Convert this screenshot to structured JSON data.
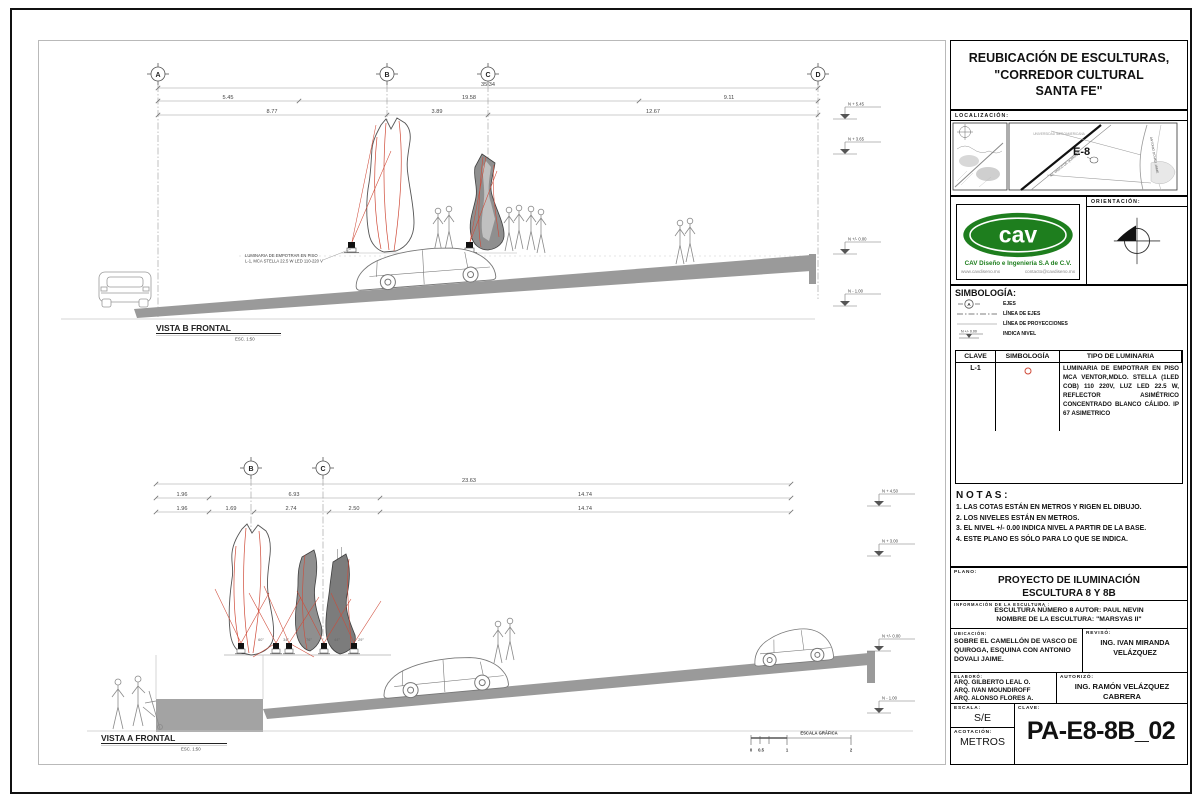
{
  "colors": {
    "accent_red": "#cf4a38",
    "logo_green": "#1e7e1e",
    "line_gray": "#8a8a8a"
  },
  "views": {
    "top": {
      "title": "VISTA B FRONTAL",
      "scale_note": "ESC. 1:50",
      "axes": [
        "A",
        "B",
        "C",
        "D"
      ],
      "dim_total": "35.34",
      "dims_row2": [
        "5.45",
        "19.58",
        "9.11"
      ],
      "dims_row3": [
        "8.77",
        "3.89",
        "12.67"
      ],
      "levels": [
        "N + 5.45",
        "N + 3.65",
        "N +/- 0.00",
        "N - 1.00"
      ],
      "annotation_line1": "LUMINARIA DE EMPOTRAR EN PISO",
      "annotation_line2": "L-1, MCA STELLA 22.5 W LED 110-220 V"
    },
    "bottom": {
      "title": "VISTA A FRONTAL",
      "scale_note": "ESC. 1:50",
      "axes": [
        "B",
        "C"
      ],
      "dim_total": "23.63",
      "dims_row2": [
        "1.96",
        "6.93",
        "14.74"
      ],
      "dims_row3": [
        "1.96",
        "1.69",
        "2.74",
        "2.50",
        "14.74"
      ],
      "levels": [
        "N + 4.50",
        "N + 3.00",
        "N +/- 0.00",
        "N - 1.00"
      ],
      "angles": [
        "60°",
        "34°",
        "76°",
        "44°",
        "29°"
      ],
      "scale_bar": {
        "label": "ESCALA GRÁFICA",
        "ticks": [
          "0",
          "0.5",
          "1",
          "2"
        ]
      }
    }
  },
  "sidebar": {
    "title_l1": "REUBICACIÓN DE ESCULTURAS,",
    "title_l2": "\"CORREDOR CULTURAL",
    "title_l3": "SANTA FE\"",
    "localizacion_label": "LOCALIZACIÓN:",
    "map": {
      "zone": "E-8",
      "area": "UNIVERSIDAD IBEROAMERICANA",
      "street_diag": "AV. VASCO DE QUIROGA",
      "street_right": "ANTONIO DOVALI JAIME"
    },
    "logo": {
      "mark": "cav",
      "company": "CAV Diseño e Ingeniería S.A de C.V.",
      "web": "www.cavdiseno.mx",
      "email": "contacto@cavdiseno.mx"
    },
    "orientacion_label": "ORIENTACIÓN:",
    "simbologia": {
      "label": "SIMBOLOGÍA:",
      "axis_symbol_letter": "A",
      "level_value": "N +/- 0.00",
      "items": [
        "EJES",
        "LÍNEA DE EJES",
        "LÍNEA DE PROYECCIONES",
        "INDICA NIVEL"
      ]
    },
    "tabla": {
      "headers": [
        "CLAVE",
        "SIMBOLOGÍA",
        "TIPO DE LUMINARIA"
      ],
      "clave": "L-1",
      "descripcion": "LUMINARIA DE EMPOTRAR EN PISO MCA VENTOR,MDLO. STELLA (1LED COB) 110 220V, LUZ LED 22.5 W, REFLECTOR ASIMÉTRICO CONCENTRADO BLANCO CÁLIDO. IP 67 ASIMETRICO"
    },
    "notas": {
      "label": "N O T A S :",
      "items": [
        "1. LAS COTAS ESTÁN EN METROS Y  RIGEN EL DIBUJO.",
        "2. LOS NIVELES ESTÁN EN METROS.",
        "3. EL NIVEL +/- 0.00 INDICA NIVEL A PARTIR DE LA BASE.",
        "4. ESTE PLANO ES SÓLO PARA LO QUE SE INDICA."
      ]
    },
    "plano": {
      "label": "PLANO:",
      "l1": "PROYECTO DE ILUMINACIÓN",
      "l2": "ESCULTURA 8 Y 8B"
    },
    "info": {
      "label": "INFORMACIÓN DE LA ESCULTURA :",
      "l1": "ESCULTURA NÚMERO 8 AUTOR: PAUL NEVIN",
      "l2": "NOMBRE DE LA ESCULTURA: \"MARSYAS II\""
    },
    "ubicacion": {
      "label": "UBICACIÓN:",
      "text": "SOBRE EL CAMELLÓN DE VASCO DE QUIROGA,  ESQUINA CON ANTONIO DOVALI JAIME."
    },
    "reviso": {
      "label": "REVISÓ:",
      "l1": "ING. IVAN MIRANDA",
      "l2": "VELÁZQUEZ"
    },
    "elaboro": {
      "label": "ELABORÓ:",
      "l1": "ARQ. GILBERTO LEAL O.",
      "l2": "ARQ. IVAN MOUNDIROFF",
      "l3": "ARQ. ALONSO FLORES A."
    },
    "autorizo": {
      "label": "AUTORIZÓ:",
      "l1": "ING. RAMÓN VELÁZQUEZ",
      "l2": "CABRERA"
    },
    "escala": {
      "label": "ESCALA:",
      "value": "S/E"
    },
    "acotacion": {
      "label": "ACOTACIÓN:",
      "value": "METROS"
    },
    "clave": {
      "label": "CLAVE:",
      "value": "PA-E8-8B_02"
    }
  }
}
